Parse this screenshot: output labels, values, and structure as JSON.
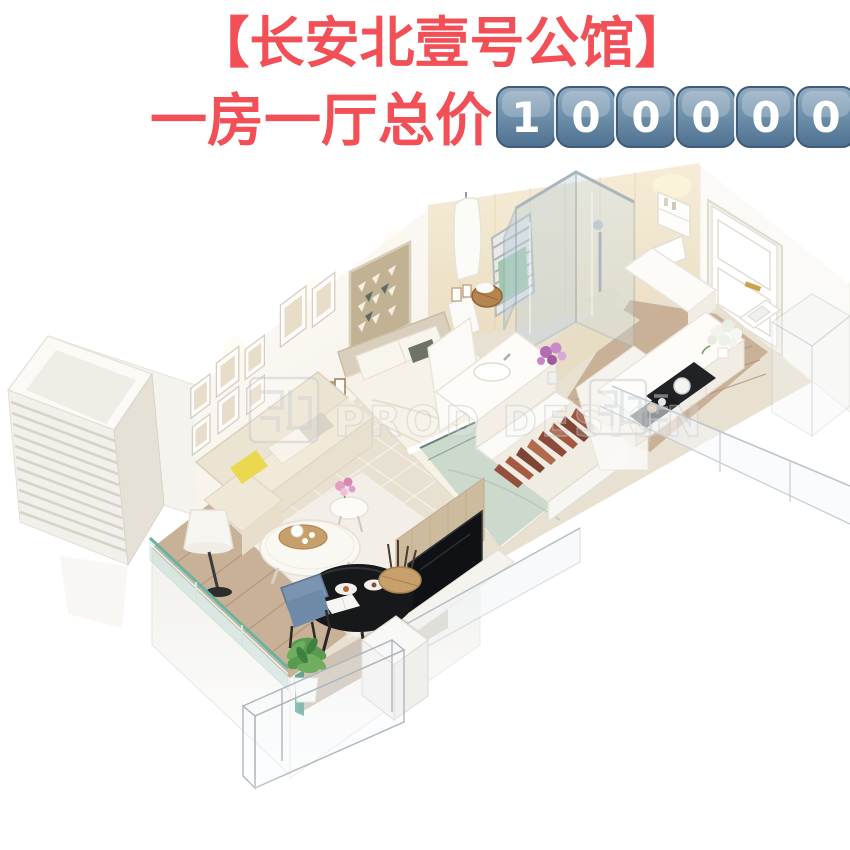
{
  "headline": {
    "line1": "【长安北壹号公馆】",
    "line2": "一房一厅总价",
    "color": "#f24f56",
    "outline": "#ffffff"
  },
  "price_keycaps": {
    "digits": [
      "1",
      "0",
      "0",
      "0",
      "0",
      "0"
    ],
    "fill_top": "#8fa9be",
    "fill_bottom": "#4e7190",
    "border": "#3d5d7a",
    "digit_color": "#ffffff"
  },
  "watermark": {
    "text": "PROD DESIGN",
    "left_icon": "seal-stamp-icon",
    "right_icon": "seal-stamp-icon"
  }
}
